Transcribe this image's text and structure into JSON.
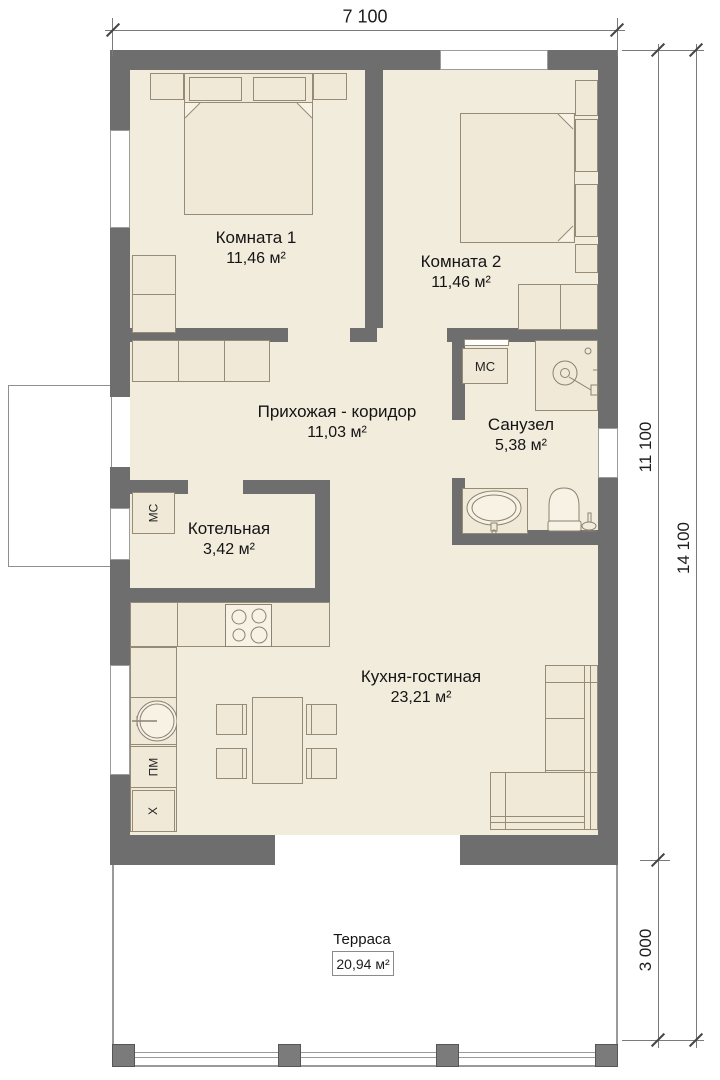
{
  "dimensions": {
    "width_top": "7 100",
    "height_house": "11 100",
    "height_terrace": "3 000",
    "height_total": "14 100"
  },
  "rooms": {
    "room1": {
      "name": "Комната 1",
      "area": "11,46 м²"
    },
    "room2": {
      "name": "Комната 2",
      "area": "11,46 м²"
    },
    "hallway": {
      "name": "Прихожая - коридор",
      "area": "11,03 м²"
    },
    "bathroom": {
      "name": "Санузел",
      "area": "5,38 м²"
    },
    "boiler": {
      "name": "Котельная",
      "area": "3,42 м²"
    },
    "kitchen": {
      "name": "Кухня-гостиная",
      "area": "23,21 м²"
    },
    "terrace": {
      "name": "Терраса",
      "area": "20,94 м²"
    }
  },
  "labels": {
    "boiler_unit": "МС",
    "washing_machine": "МС",
    "dishwasher": "ПМ",
    "fridge": "Х"
  },
  "colors": {
    "wall": "#6e6e6e",
    "floor": "#f2ecdd",
    "furniture_outline": "#958b77",
    "background": "#ffffff"
  }
}
